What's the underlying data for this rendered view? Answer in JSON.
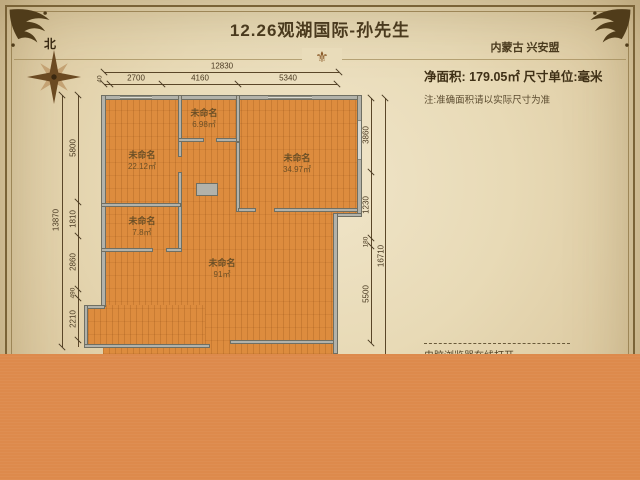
{
  "header": {
    "title": "12.26观湖国际-孙先生",
    "region": "内蒙古 兴安盟",
    "net_area_line": "净面积: 179.05㎡  尺寸单位:毫米",
    "note": "注:准确面积请以实际尺寸为准",
    "bottom_note": "电脑浏览器在线打开",
    "north_label": "北",
    "divider_ornament": "⚜"
  },
  "colors": {
    "paper": "#e9dcba",
    "floor_orange": "#dd8c3e",
    "overlay_orange": "#dd8a4c",
    "wall_gray": "#b2b2aa",
    "ink_brown": "#4a3a1e"
  },
  "plan": {
    "rooms": [
      {
        "name": "未命名",
        "area": "6.98㎡"
      },
      {
        "name": "未命名",
        "area": "22.12㎡"
      },
      {
        "name": "未命名",
        "area": "34.97㎡"
      },
      {
        "name": "未命名",
        "area": "7.8㎡"
      },
      {
        "name": "未命名",
        "area": "91㎡"
      }
    ],
    "dims": {
      "top_total": "12830",
      "top_segments": [
        "40",
        "2700",
        "4160",
        "5340"
      ],
      "left_total": "13870",
      "left_segments": [
        "5800",
        "1810",
        "2860",
        "490",
        "2210"
      ],
      "right_total": "16710",
      "right_segments": [
        "3860",
        "1230",
        "180",
        "5500"
      ]
    }
  }
}
